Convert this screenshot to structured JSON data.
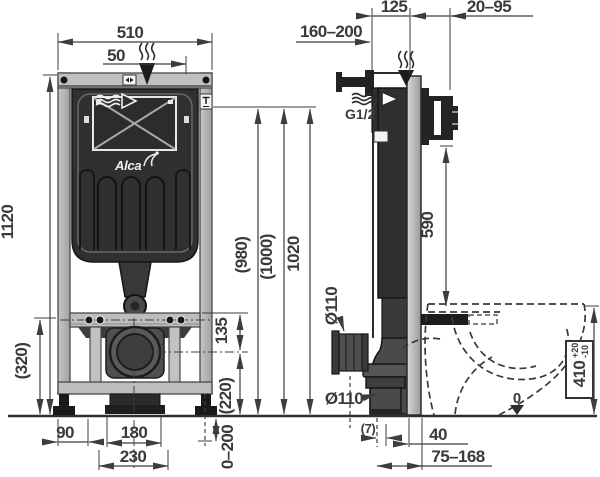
{
  "drawing": {
    "kind": "wc-installation-frame-technical-drawing",
    "brand_logo": "Alca"
  },
  "icons": {
    "steam-down-icon": "wavy-lines-with-down-arrow",
    "water-flow-icon": "wavy-arrow-right",
    "flush-plate-icon": "double-triangle-badge",
    "tee-label-icon": "T-badge",
    "zero-level-icon": "down-arrow",
    "brand-swan-icon": "swan-curve",
    "inspection-window-icon": "crossed-rectangle"
  },
  "labels": {
    "front": {
      "width_total": "510",
      "top_offset": "50",
      "frame_height": "1120",
      "bracket_height": "(320)",
      "bracket_to_drain": "135",
      "drain_height": "(220)",
      "flush_h_a": "(980)",
      "flush_h_b": "(1000)",
      "flush_h_c": "1020",
      "side_clear": "90",
      "outlet_width": "180",
      "cutout_width": "230",
      "leg_adjust": "0–200"
    },
    "side": {
      "flush_pipe_range": "160–200",
      "frame_depth": "125",
      "wall_distance": "20–95",
      "water_inlet": "G1/2",
      "bracket_to_studs": "590",
      "pipe_dia_upper": "Ø110",
      "pipe_dia_lower": "Ø110",
      "bowl_height": "410",
      "bowl_tol_plus": "+20",
      "bowl_tol_minus": "-10",
      "floor_zero": "0",
      "gap_small": "(7)",
      "rail_depth": "40",
      "drain_offset_range": "75–168"
    }
  }
}
